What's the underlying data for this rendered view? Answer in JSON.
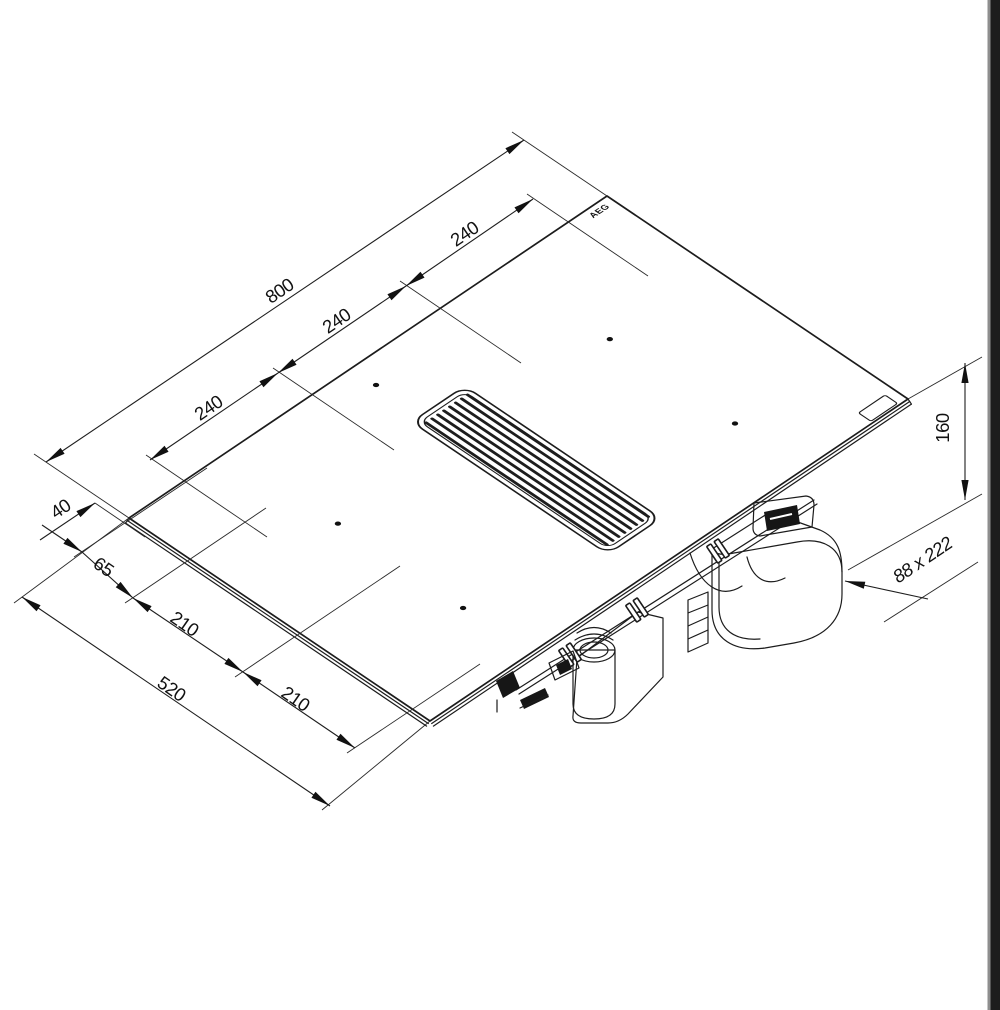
{
  "page": {
    "background": "#ffffff",
    "scan_edge_color": "#1d1d1d",
    "line_color": "#1c1c1c"
  },
  "brand_logo": "AEG",
  "dimensions": {
    "total_width": "800",
    "zone_spacing_right": "240",
    "zone_spacing_mid": "240",
    "zone_spacing_left": "240",
    "rear_edge_offset": "40",
    "front_edge_offset": "65",
    "zone_row_spacing_rear": "210",
    "zone_row_spacing_front": "210",
    "total_depth": "520",
    "installation_height": "160",
    "duct_outlet_size": "88 x 222"
  }
}
